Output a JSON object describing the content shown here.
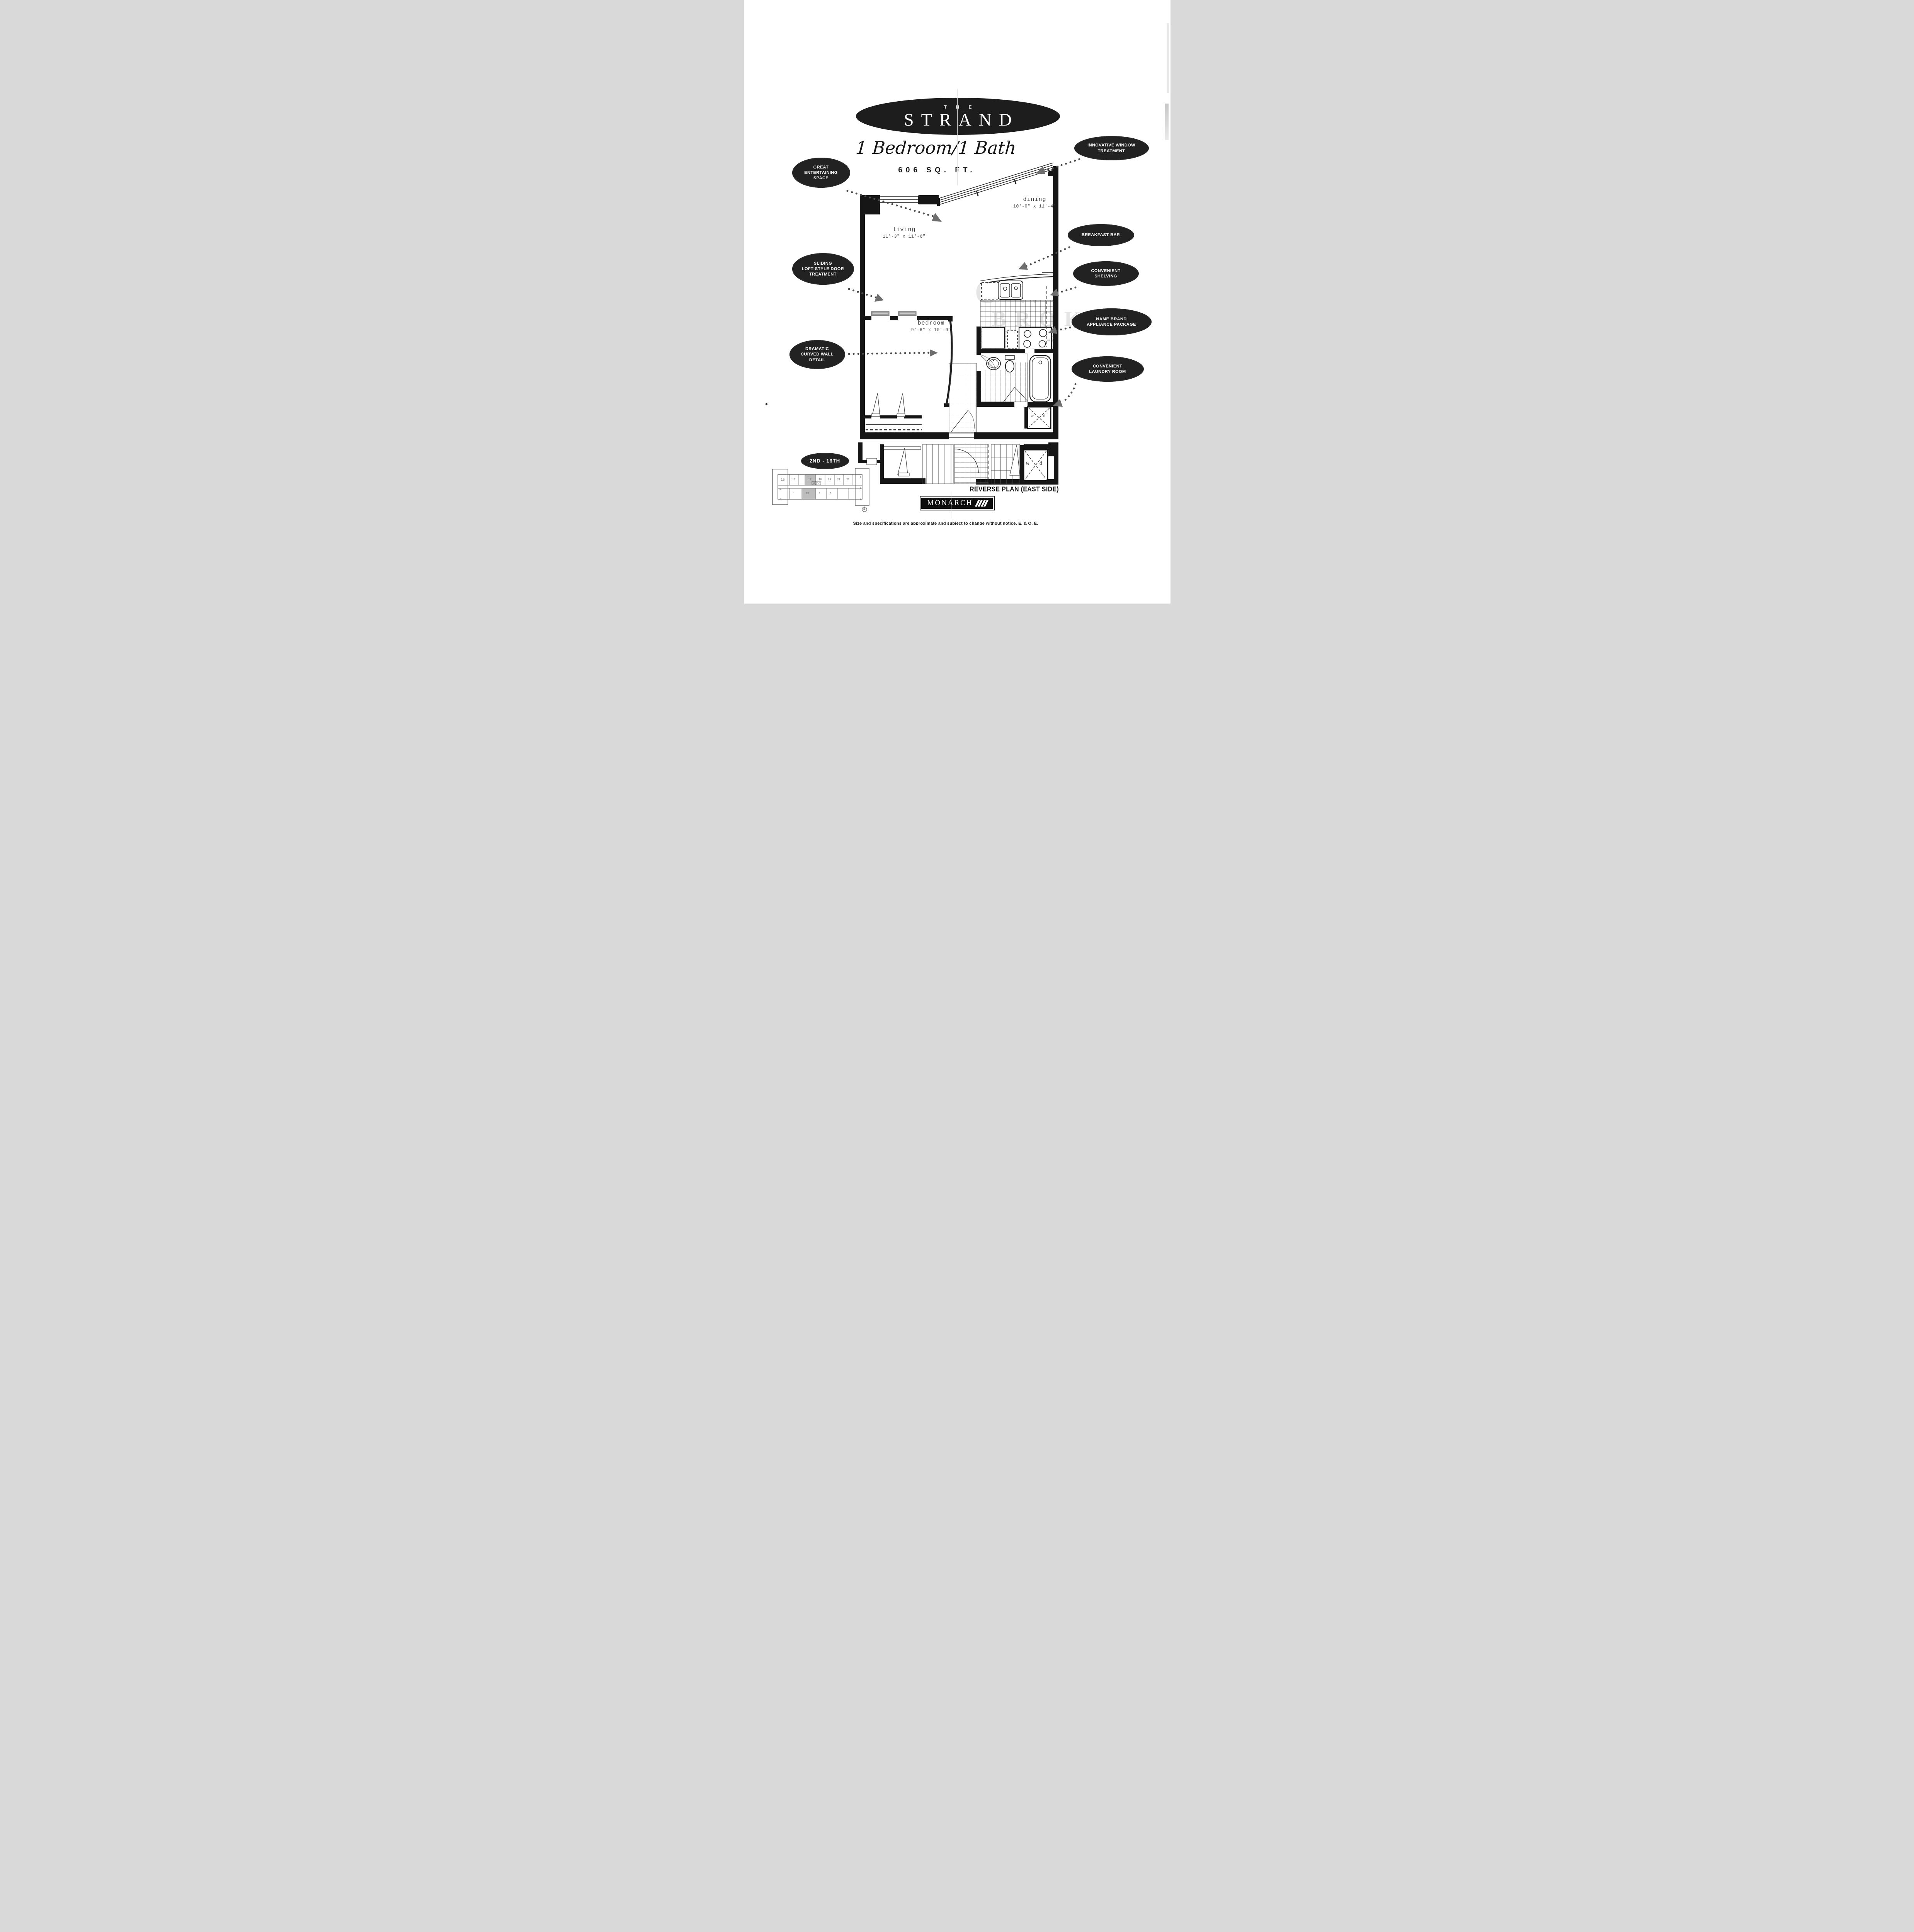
{
  "page": {
    "title_small": "THE",
    "title": "STRAND",
    "subtitle": "1 Bedroom/1 Bath",
    "area": "606 SQ. FT."
  },
  "callouts": {
    "entertaining": "GREAT\nENTERTAINING\nSPACE",
    "window": "INNOVATIVE WINDOW\nTREATMENT",
    "breakfast": "BREAKFAST BAR",
    "shelving": "CONVENIENT\nSHELVING",
    "appliance": "NAME BRAND\nAPPLIANCE PACKAGE",
    "laundry": "CONVENIENT\nLAUNDRY ROOM",
    "sliding": "SLIDING\nLOFT-STYLE DOOR\nTREATMENT",
    "curved": "DRAMATIC\nCURVED WALL\nDETAIL",
    "floors": "2ND - 16TH"
  },
  "rooms": {
    "living": {
      "name": "living",
      "dims": "11'-3\" x 11'-6\""
    },
    "dining": {
      "name": "dining",
      "dims": "10'-0\" x 11'-4\""
    },
    "bedroom": {
      "name": "bedroom",
      "dims": "9'-6\" x 10'-9\""
    }
  },
  "laundry": {
    "washer": "w",
    "dryer": "d"
  },
  "footer": {
    "reverse_label": "REVERSE PLAN (EAST SIDE)",
    "brand": "MONARCH",
    "disclaimer": "Size and specifications are approximate and subject to change without notice.  E. & O. E."
  },
  "watermark": {
    "line1": "OW",
    "line2": "BROK"
  },
  "key_plan": {
    "units_top": [
      "15",
      "16",
      "17",
      "18",
      "19",
      "21",
      "22"
    ],
    "units_left": [
      "14"
    ],
    "units_right": [
      "1",
      "6",
      "5"
    ],
    "units_bottom": [
      "4",
      "1",
      "10",
      "8",
      "2"
    ],
    "compass": "S"
  },
  "colors": {
    "ink": "#1a1a1a",
    "oval_bg": "#222222",
    "arrow": "#6e6e6e",
    "shade": "#bdbdbd"
  }
}
